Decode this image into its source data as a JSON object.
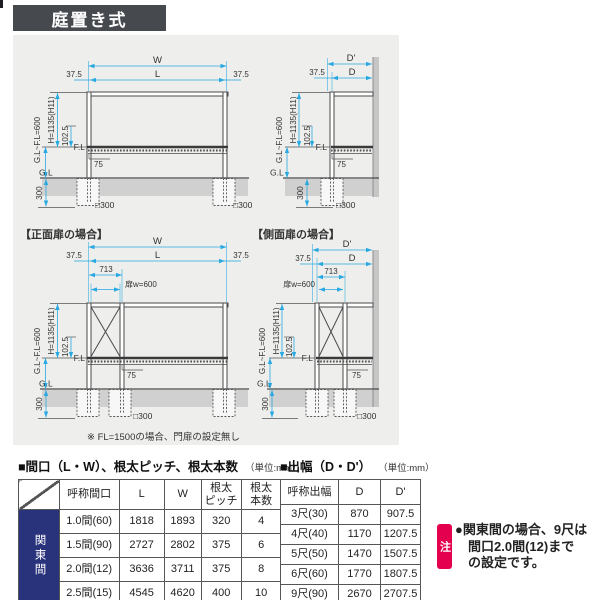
{
  "page": {
    "title_bar": "庭置き式"
  },
  "colors": {
    "accent_cyan": "#29a9e1",
    "navy": "#29337b",
    "note_red": "#e5004f",
    "header_gray": "#46494e"
  },
  "diagrams": {
    "captions": {
      "front_gate": "【正面扉の場合】",
      "side_gate": "【側面扉の場合】"
    },
    "footnote": "※ FL=1500の場合、門扉の設定無し",
    "dims": {
      "w": "W",
      "l": "L",
      "d": "D",
      "d_prime": "D'",
      "margin": "37.5",
      "gate_offset": "713",
      "gate_width": "扉w=600",
      "gl_to_fl": "G.L~F.L=600",
      "height": "H=1135(H11)",
      "deck_thickness": "102.5",
      "fl": "F.L",
      "gl": "G.L",
      "beam_75": "75",
      "embed_300": "300",
      "footing": "□300"
    }
  },
  "tables": {
    "maguchi": {
      "title": "■間口（L・W）、根太ピッチ、根太本数",
      "unit": "（単位:mm）",
      "region_label": "関東間",
      "headers": [
        [
          "呼称間口"
        ],
        [
          "L"
        ],
        [
          "W"
        ],
        [
          "根太",
          "ピッチ"
        ],
        [
          "根太",
          "本数"
        ]
      ],
      "rows": [
        {
          "name": "1.0間(60)",
          "l": "1818",
          "w": "1893",
          "pitch": "320",
          "count": "4"
        },
        {
          "name": "1.5間(90)",
          "l": "2727",
          "w": "2802",
          "pitch": "375",
          "count": "6"
        },
        {
          "name": "2.0間(12)",
          "l": "3636",
          "w": "3711",
          "pitch": "375",
          "count": "8"
        },
        {
          "name": "2.5間(15)",
          "l": "4545",
          "w": "4620",
          "pitch": "400",
          "count": "10"
        }
      ]
    },
    "debaba": {
      "title": "■出幅（D・D'）",
      "unit": "（単位:mm）",
      "headers": [
        [
          "呼称出幅"
        ],
        [
          "D"
        ],
        [
          "D'"
        ]
      ],
      "rows": [
        {
          "name": "3尺(30)",
          "d": "870",
          "dp": "907.5"
        },
        {
          "name": "4尺(40)",
          "d": "1170",
          "dp": "1207.5"
        },
        {
          "name": "5尺(50)",
          "d": "1470",
          "dp": "1507.5"
        },
        {
          "name": "6尺(60)",
          "d": "1770",
          "dp": "1807.5"
        },
        {
          "name": "9尺(90)",
          "d": "2670",
          "dp": "2707.5"
        }
      ]
    }
  },
  "note": {
    "badge": "注",
    "lines": [
      "●関東間の場合、9尺は",
      "間口2.0間(12)まで",
      "の設定です。"
    ]
  }
}
